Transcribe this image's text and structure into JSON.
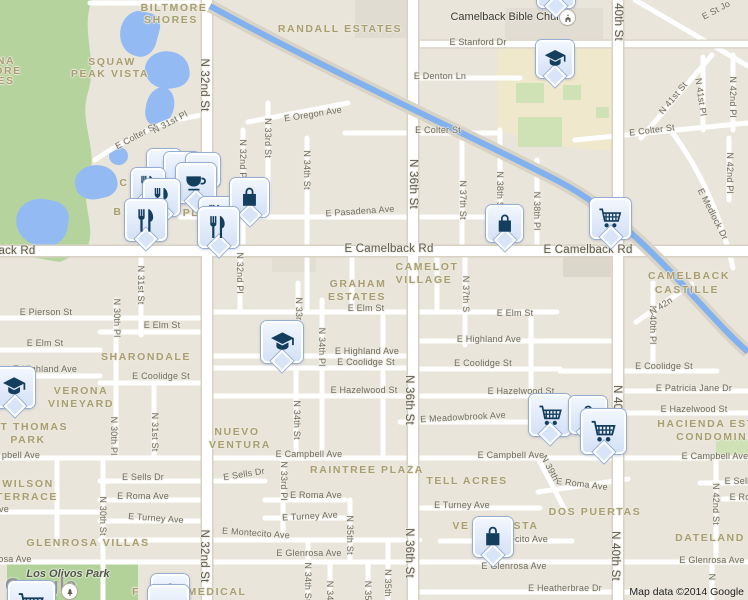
{
  "map": {
    "attribution": "Map data ©2014 Google",
    "watermark": "Google"
  },
  "colors": {
    "water": "#93baf3",
    "canal": "#82b1f0",
    "green": "#b5d39c",
    "park_green": "#b2d29a",
    "campus": "#efe8cc",
    "campus_green": "#cfe2b6",
    "marker_icon": "#143e5d",
    "neighborhood_text": "#a99e71",
    "street_text": "#6f6c61"
  },
  "places": {
    "church": {
      "name": "Camelback Bible Church"
    },
    "park": {
      "name": "Los Olivos Park"
    }
  },
  "pois": [
    {
      "type": "church",
      "x": 560,
      "y": 10
    },
    {
      "type": "park",
      "x": 62,
      "y": 584
    }
  ],
  "neighborhood_labels": [
    {
      "t": "BILTMORE",
      "x": 174,
      "y": 8
    },
    {
      "t": "SHORES",
      "x": 171,
      "y": 20
    },
    {
      "t": "SQUAW",
      "x": 112,
      "y": 62
    },
    {
      "t": "PEAK VISTA",
      "x": 110,
      "y": 74
    },
    {
      "t": "RANDALL ESTATES",
      "x": 340,
      "y": 29
    },
    {
      "t": "NA",
      "x": 6,
      "y": 61
    },
    {
      "t": "ORE",
      "x": 8,
      "y": 71
    },
    {
      "t": "ES",
      "x": 6,
      "y": 81
    },
    {
      "t": "C",
      "x": 124,
      "y": 183
    },
    {
      "t": "MS",
      "x": 213,
      "y": 183
    },
    {
      "t": "B",
      "x": 118,
      "y": 212
    },
    {
      "t": "PL",
      "x": 191,
      "y": 213
    },
    {
      "t": "CAMELOT",
      "x": 427,
      "y": 267
    },
    {
      "t": "VILLAGE",
      "x": 424,
      "y": 280
    },
    {
      "t": "GRAHAM",
      "x": 358,
      "y": 284
    },
    {
      "t": "ESTATES",
      "x": 357,
      "y": 297
    },
    {
      "t": "CAMELBACK",
      "x": 689,
      "y": 276
    },
    {
      "t": "CASTILLE",
      "x": 687,
      "y": 290
    },
    {
      "t": "SHARONDALE",
      "x": 146,
      "y": 357
    },
    {
      "t": "VERONA",
      "x": 81,
      "y": 391
    },
    {
      "t": "VINEYARD",
      "x": 81,
      "y": 404
    },
    {
      "t": "ST THOMAS",
      "x": 30,
      "y": 427
    },
    {
      "t": "PARK",
      "x": 28,
      "y": 440
    },
    {
      "t": "NUEVO",
      "x": 237,
      "y": 432
    },
    {
      "t": "VENTURA",
      "x": 240,
      "y": 445
    },
    {
      "t": "WILSON",
      "x": 28,
      "y": 484
    },
    {
      "t": "TERRACE",
      "x": 27,
      "y": 497
    },
    {
      "t": "GLENROSA VILLAS",
      "x": 88,
      "y": 543
    },
    {
      "t": "RAINTREE PLAZA",
      "x": 367,
      "y": 470
    },
    {
      "t": "TELL ACRES",
      "x": 467,
      "y": 481
    },
    {
      "t": "VE",
      "x": 461,
      "y": 526
    },
    {
      "t": "STA",
      "x": 526,
      "y": 526
    },
    {
      "t": "DOS PUERTAS",
      "x": 595,
      "y": 512
    },
    {
      "t": "DATELAND",
      "x": 710,
      "y": 538
    },
    {
      "t": "HACIENDA EST",
      "x": 706,
      "y": 424
    },
    {
      "t": "CONDOMINI",
      "x": 714,
      "y": 437
    },
    {
      "t": "F",
      "x": 136,
      "y": 592
    },
    {
      "t": "MEDICAL",
      "x": 217,
      "y": 592
    }
  ],
  "street_labels": [
    {
      "t": "ack Rd",
      "x": 17,
      "y": 251,
      "big": true
    },
    {
      "t": "E Camelback Rd",
      "x": 389,
      "y": 249,
      "big": true
    },
    {
      "t": "E Camelback Rd",
      "x": 588,
      "y": 250,
      "big": true
    },
    {
      "t": "E Stanford Dr",
      "x": 478,
      "y": 42
    },
    {
      "t": "E Denton Ln",
      "x": 440,
      "y": 76
    },
    {
      "t": "E Oregon Ave",
      "x": 313,
      "y": 114,
      "rot": -9
    },
    {
      "t": "E Colter St",
      "x": 438,
      "y": 130
    },
    {
      "t": "E Colter St",
      "x": 652,
      "y": 130,
      "rot": -7
    },
    {
      "t": "E Colter St",
      "x": 136,
      "y": 136,
      "rot": -28
    },
    {
      "t": "E Pasadena Ave",
      "x": 360,
      "y": 211,
      "rot": -4
    },
    {
      "t": "E Medlock Dr",
      "x": 713,
      "y": 214,
      "rot": 63
    },
    {
      "t": "E St Jo",
      "x": 716,
      "y": 10,
      "rot": -28
    },
    {
      "t": "E Pierson St",
      "x": 46,
      "y": 312
    },
    {
      "t": "E Elm St",
      "x": 45,
      "y": 343
    },
    {
      "t": "E Elm St",
      "x": 162,
      "y": 325
    },
    {
      "t": "E Elm St",
      "x": 366,
      "y": 308
    },
    {
      "t": "E Elm St",
      "x": 515,
      "y": 313
    },
    {
      "t": "E Highland Ave",
      "x": 45,
      "y": 369
    },
    {
      "t": "E Highland Ave",
      "x": 367,
      "y": 351
    },
    {
      "t": "E Highland Ave",
      "x": 489,
      "y": 339
    },
    {
      "t": "E Coolidge St",
      "x": 161,
      "y": 376
    },
    {
      "t": "E Coolidge St",
      "x": 366,
      "y": 362
    },
    {
      "t": "E Coolidge St",
      "x": 483,
      "y": 363
    },
    {
      "t": "E Coolidge St",
      "x": 664,
      "y": 366
    },
    {
      "t": "E Patricia Jane Dr",
      "x": 694,
      "y": 388
    },
    {
      "t": "E Hazelwood St",
      "x": 364,
      "y": 390
    },
    {
      "t": "E Hazelwood St",
      "x": 521,
      "y": 391
    },
    {
      "t": "E Hazelwood St",
      "x": 694,
      "y": 409
    },
    {
      "t": "E Meadowbrook Ave",
      "x": 463,
      "y": 417,
      "rot": -3
    },
    {
      "t": "pbell Ave",
      "x": 21,
      "y": 455
    },
    {
      "t": "E Campbell Ave",
      "x": 309,
      "y": 454
    },
    {
      "t": "E Campbell Ave",
      "x": 511,
      "y": 455
    },
    {
      "t": "E Campbell Ave",
      "x": 715,
      "y": 456
    },
    {
      "t": "E Sells Dr",
      "x": 143,
      "y": 477
    },
    {
      "t": "E Sells Dr",
      "x": 244,
      "y": 474,
      "rot": -9
    },
    {
      "t": "E Sell",
      "x": 737,
      "y": 481
    },
    {
      "t": "E Roma Ave",
      "x": 143,
      "y": 496
    },
    {
      "t": "E Roma Ave",
      "x": 316,
      "y": 495
    },
    {
      "t": "E Roma Ave",
      "x": 582,
      "y": 484,
      "rot": 7
    },
    {
      "t": "E Ro",
      "x": 740,
      "y": 497
    },
    {
      "t": "E Turney Ave",
      "x": 156,
      "y": 518,
      "rot": 4
    },
    {
      "t": "E Turney Ave",
      "x": 310,
      "y": 516,
      "rot": -3
    },
    {
      "t": "E Turney Ave",
      "x": 462,
      "y": 505
    },
    {
      "t": "E Montecito Ave",
      "x": 256,
      "y": 533,
      "rot": 4
    },
    {
      "t": "E Montecito Ave",
      "x": 514,
      "y": 539
    },
    {
      "t": "osa Ave",
      "x": 15,
      "y": 559
    },
    {
      "t": "E Glenrosa Ave",
      "x": 309,
      "y": 553
    },
    {
      "t": "E Glenrosa Ave",
      "x": 514,
      "y": 566
    },
    {
      "t": "E Glenrosa Ave",
      "x": 712,
      "y": 560
    },
    {
      "t": "E Heatherbrae Dr",
      "x": 565,
      "y": 588
    },
    {
      "t": "ve",
      "x": 4,
      "y": 509
    },
    {
      "t": "N 32nd St",
      "x": 204,
      "y": 85,
      "v": true,
      "big": true
    },
    {
      "t": "N 32nd St",
      "x": 204,
      "y": 556,
      "v": true,
      "big": true
    },
    {
      "t": "N 32nd Pl",
      "x": 243,
      "y": 160,
      "v": true
    },
    {
      "t": "N 32nd Pl",
      "x": 240,
      "y": 273,
      "v": true
    },
    {
      "t": "N 31st Pl",
      "x": 170,
      "y": 122,
      "rot": -28
    },
    {
      "t": "N 31st St",
      "x": 141,
      "y": 285,
      "v": true
    },
    {
      "t": "N 31st St",
      "x": 155,
      "y": 432,
      "v": true
    },
    {
      "t": "N 30th St",
      "x": 103,
      "y": 516,
      "v": true
    },
    {
      "t": "N 30th Pl",
      "x": 117,
      "y": 318,
      "v": true
    },
    {
      "t": "N 30th Pl",
      "x": 114,
      "y": 436,
      "v": true
    },
    {
      "t": "N 33rd St",
      "x": 268,
      "y": 138,
      "v": true
    },
    {
      "t": "N 33rd Pl",
      "x": 299,
      "y": 317,
      "v": true
    },
    {
      "t": "N 33rd Pl",
      "x": 284,
      "y": 481,
      "v": true
    },
    {
      "t": "N 34th St",
      "x": 307,
      "y": 170,
      "v": true
    },
    {
      "t": "N 34th Pl",
      "x": 322,
      "y": 347,
      "v": true
    },
    {
      "t": "N 34th St",
      "x": 297,
      "y": 420,
      "v": true
    },
    {
      "t": "N 34th St",
      "x": 308,
      "y": 582,
      "v": true
    },
    {
      "t": "N 34t",
      "x": 330,
      "y": 592,
      "v": true
    },
    {
      "t": "N 35th St",
      "x": 350,
      "y": 535,
      "v": true
    },
    {
      "t": "N 35t",
      "x": 368,
      "y": 592,
      "v": true
    },
    {
      "t": "N 35th",
      "x": 388,
      "y": 583,
      "v": true
    },
    {
      "t": "N 36th St",
      "x": 413,
      "y": 184,
      "v": true,
      "big": true
    },
    {
      "t": "N 36th St",
      "x": 409,
      "y": 400,
      "v": true,
      "big": true
    },
    {
      "t": "N 36th St",
      "x": 409,
      "y": 553,
      "v": true,
      "big": true
    },
    {
      "t": "N 37th St",
      "x": 463,
      "y": 200,
      "v": true
    },
    {
      "t": "N 37th S",
      "x": 466,
      "y": 294,
      "v": true
    },
    {
      "t": "N 38th St",
      "x": 500,
      "y": 191,
      "v": true
    },
    {
      "t": "N 38th Pl",
      "x": 537,
      "y": 211,
      "v": true
    },
    {
      "t": "N 39th",
      "x": 550,
      "y": 468,
      "rot": 62
    },
    {
      "t": "40th St",
      "x": 618,
      "y": 22,
      "v": true,
      "big": true
    },
    {
      "t": "N 40th St",
      "x": 617,
      "y": 410,
      "v": true,
      "big": true
    },
    {
      "t": "N 40th St",
      "x": 615,
      "y": 556,
      "v": true,
      "big": true
    },
    {
      "t": "N 40th Pl",
      "x": 653,
      "y": 325,
      "v": true
    },
    {
      "t": "N 41st St",
      "x": 673,
      "y": 98,
      "rot": -50
    },
    {
      "t": "N 41st Pl",
      "x": 701,
      "y": 97,
      "rot": 82
    },
    {
      "t": "N 42nd Pl",
      "x": 733,
      "y": 97,
      "v": true
    },
    {
      "t": "N 42nd Pl",
      "x": 730,
      "y": 173,
      "v": true
    },
    {
      "t": "N 42n",
      "x": 661,
      "y": 306,
      "rot": -33
    },
    {
      "t": "N 42nd St",
      "x": 716,
      "y": 504,
      "v": true
    },
    {
      "t": "N",
      "x": 712,
      "y": 577,
      "v": true
    }
  ],
  "markers": [
    {
      "type": "plain",
      "x": 147,
      "y": 149,
      "s": 34
    },
    {
      "type": "plain",
      "x": 164,
      "y": 152,
      "s": 36
    },
    {
      "type": "plain",
      "x": 186,
      "y": 153,
      "s": 34
    },
    {
      "type": "restaurant",
      "x": 131,
      "y": 168,
      "s": 34
    },
    {
      "type": "cafe",
      "x": 176,
      "y": 163,
      "s": 40
    },
    {
      "type": "restaurant",
      "x": 143,
      "y": 179,
      "s": 37
    },
    {
      "type": "restaurant",
      "x": 199,
      "y": 197,
      "s": 34
    },
    {
      "type": "shopping-bag",
      "x": 230,
      "y": 178,
      "s": 39
    },
    {
      "type": "restaurant",
      "x": 125,
      "y": 199,
      "s": 42
    },
    {
      "type": "restaurant",
      "x": 198,
      "y": 207,
      "s": 41
    },
    {
      "type": "plain",
      "x": 537,
      "y": -30,
      "s": 38
    },
    {
      "type": "school",
      "x": 536,
      "y": 40,
      "s": 38
    },
    {
      "type": "cart",
      "x": 590,
      "y": 198,
      "s": 41
    },
    {
      "type": "shopping-bag",
      "x": 486,
      "y": 205,
      "s": 37
    },
    {
      "type": "school",
      "x": 261,
      "y": 321,
      "s": 42
    },
    {
      "type": "school",
      "x": -6,
      "y": 367,
      "s": 41
    },
    {
      "type": "cart",
      "x": 529,
      "y": 394,
      "s": 42
    },
    {
      "type": "shopping-bag",
      "x": 569,
      "y": 396,
      "s": 38
    },
    {
      "type": "cart",
      "x": 581,
      "y": 409,
      "s": 45
    },
    {
      "type": "shopping-bag",
      "x": 473,
      "y": 517,
      "s": 40
    },
    {
      "type": "shopping-bag",
      "x": 151,
      "y": 574,
      "s": 38
    },
    {
      "type": "plain",
      "x": 148,
      "y": 585,
      "s": 41
    },
    {
      "type": "cart",
      "x": 8,
      "y": 581,
      "s": 47
    }
  ]
}
